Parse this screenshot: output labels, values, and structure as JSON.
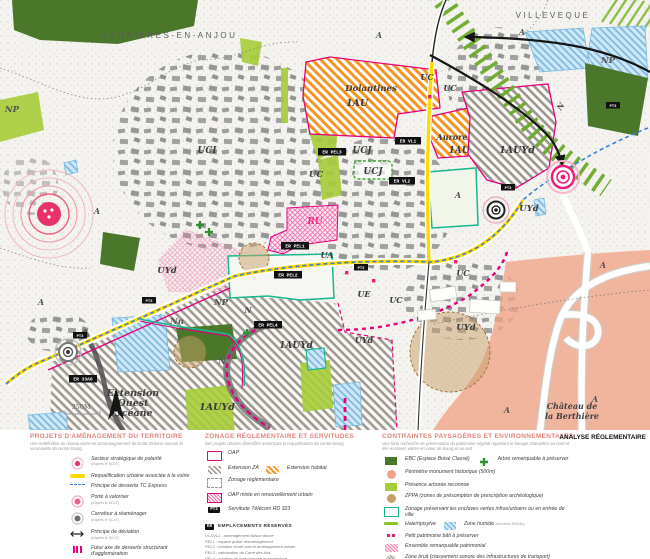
{
  "title": "ANALYSE RÉGLEMENTAIRE",
  "colors": {
    "magenta": "#e5007e",
    "orange": "#f5921e",
    "yellow": "#ffd900",
    "teal": "#17b890",
    "ebc_green": "#4a7729",
    "light_green": "#a6cc39",
    "stripe_green": "#69aa28",
    "tc_blue": "#3a7fd5",
    "zone_humide": "#9fcfeb",
    "zone_bruit": "#f0a58a",
    "polarite_red": "#ee3a63",
    "zppa_tan": "#c8a06a"
  },
  "map": {
    "scale_label": "350M",
    "north_label": "N",
    "place_labels": [
      "VERRIERES-EN-ANJOU",
      "VILLEVEQUE"
    ],
    "area_names": {
      "dolantines": "Dolantines",
      "aurore": "Aurore",
      "ext1": "Extension",
      "ext2": "Ouest",
      "ext3": "Océane",
      "chateau1": "Château de",
      "chateau2": "la Berthière"
    },
    "ucj_box": "UCJ",
    "zone_labels": [
      "UCI",
      "UCJ",
      "UC",
      "UC",
      "UC",
      "UC",
      "UC",
      "UE",
      "UA",
      "RU",
      "UYd",
      "UYd",
      "UYd",
      "UYd",
      "1AU",
      "1AU",
      "1AUYd",
      "1AUYd",
      "1AUYd",
      "A",
      "A",
      "A",
      "A",
      "A",
      "A",
      "A",
      "A",
      "N",
      "N",
      "N",
      "Nn",
      "NP",
      "NP",
      "NP"
    ],
    "er_boxes": [
      {
        "t": "ER PEL3",
        "x": 332,
        "y": 152
      },
      {
        "t": "ER VL1",
        "x": 408,
        "y": 141
      },
      {
        "t": "ER VL2",
        "x": 402,
        "y": 181
      },
      {
        "t": "ER PEL1",
        "x": 295,
        "y": 246
      },
      {
        "t": "ER PEL2",
        "x": 288,
        "y": 275
      },
      {
        "t": "ER PEL4",
        "x": 268,
        "y": 325
      },
      {
        "t": "ER 33A6",
        "x": 83,
        "y": 379
      }
    ],
    "pt_boxes": [
      {
        "t": "PT3",
        "x": 361,
        "y": 268
      },
      {
        "t": "PT3",
        "x": 508,
        "y": 188
      },
      {
        "t": "PT3",
        "x": 613,
        "y": 106
      },
      {
        "t": "PT3",
        "x": 80,
        "y": 336
      },
      {
        "t": "PT3",
        "x": 149,
        "y": 301
      }
    ]
  },
  "legend": {
    "col1": {
      "title": "PROJETS D'AMÉNAGEMENT DU TERRITOIRE",
      "subtitle": "Une redéfinition du réseau viaire en accompagnement de la D6 Océane ouvrant la reconquête du centre-bourg.",
      "items": [
        {
          "label": "Secteur stratégique de polarité",
          "sub": "(d'après le SCoT)"
        },
        {
          "label": "Requalification urbaine associée à la voirie"
        },
        {
          "label": "Principe de desserte TC Express"
        },
        {
          "label": "Porte à valoriser",
          "sub": "(d'après le SCoT)"
        },
        {
          "label": "Carrefour à réaménager",
          "sub": "(d'après le SCoT)"
        },
        {
          "label": "Principe de déviation",
          "sub": "(d'après le SCoT)"
        },
        {
          "label": "Futur axe de desserte structurant d'agglomération"
        },
        {
          "label": "Discontinuité ville/campagne",
          "sub": "(d'après le SCoT)"
        }
      ]
    },
    "col2": {
      "title": "ZONAGE RÉGLEMENTAIRE ET SERVITUDES",
      "subtitle": "Des projets urbains diversifiés annonçant la requalification du centre-bourg.",
      "items": [
        {
          "label": "OAP"
        },
        {
          "label": "Extension ZA",
          "label2": "Extension habitat"
        },
        {
          "label": "Zonage réglementaire"
        },
        {
          "label": "OAP mixte en renouvellement urbain"
        },
        {
          "label": "Servitude Télécom RD 323"
        }
      ],
      "servitude_tag": "PT3",
      "er_tag": "ER",
      "er_title": "EMPLACEMENTS RÉSERVÉS",
      "er_items": [
        "VL1/VL2 : aménagement liaison douce",
        "PEL1 : espace public réaménagement",
        "PEL2 : création d'une voie et aménagement urbain",
        "PEL3 : valorisation du Carré des Arts",
        "PEL4 : création de voie primaire et secondaire",
        "PEL5 : élargissement de la voie",
        "33A6 : création de voie primaire et secondaire"
      ]
    },
    "col3": {
      "title": "CONTRAINTES PAYSAGÈRES ET ENVIRONNEMENTALES",
      "subtitle": "Une forte recherche de préservation du patrimoine végétal rappelant le bocage champêtre au nord et des enclaves vertes en cœur de bourg et au sud",
      "items": [
        {
          "label": "EBC (Espace Boisé Classé)",
          "label2": "Arbre remarquable à préserver"
        },
        {
          "label": "Périmètre monument historique (500m)"
        },
        {
          "label": "Présence arborée reconnue"
        },
        {
          "label": "ZPPA (zones de présomption de prescription archéologique)"
        },
        {
          "label": "Zonage préservant les enclaves vertes infras/urbains ou en entrée de ville"
        },
        {
          "label": "Haie/ripisylve",
          "label2": "Zone humide",
          "sub2": "(données DREAL)"
        },
        {
          "label": "Petit patrimoine bâti à préserver"
        },
        {
          "label": "Ensemble remarquable patrimonial"
        },
        {
          "label": "Zone bruit (classement sonore des infrastructures de transport)"
        }
      ]
    },
    "col4": {
      "title": "ANALYSE RÉGLEMENTAIRE"
    }
  }
}
